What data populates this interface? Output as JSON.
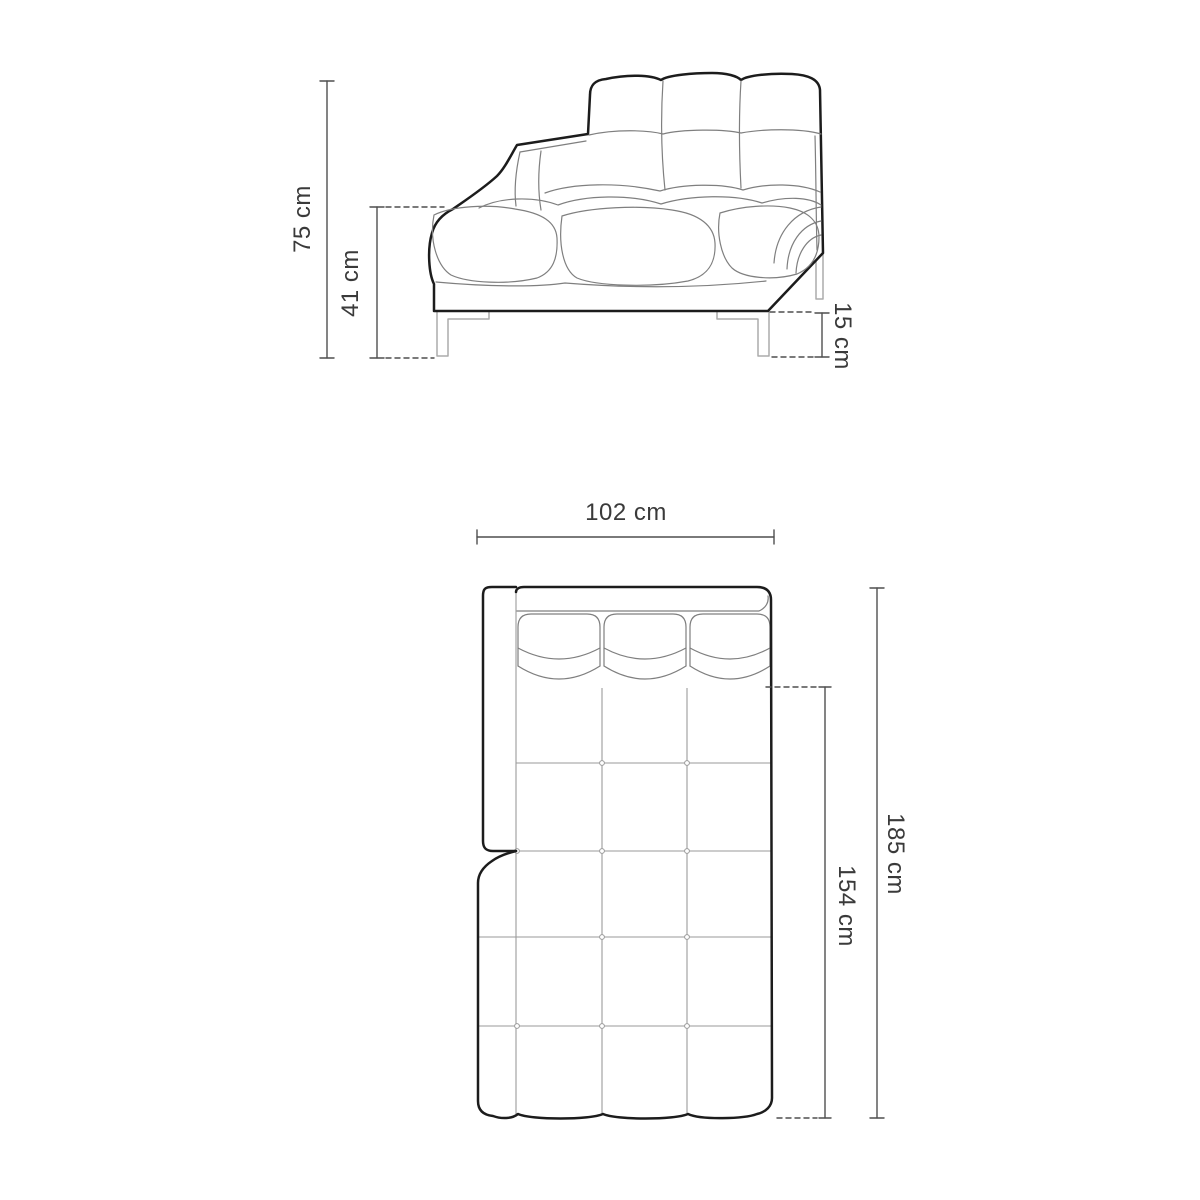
{
  "side_view": {
    "overall_height": "75 cm",
    "seat_height": "41 cm",
    "leg_height": "15 cm"
  },
  "top_view": {
    "width": "102 cm",
    "overall_length": "185 cm",
    "seat_length": "154 cm"
  },
  "colors": {
    "background": "#ffffff",
    "outline": "#1c1c1c",
    "detail": "#7f7f7f",
    "grid": "#9a9a9a",
    "leg": "#ababab",
    "dimension": "#4f4f4f",
    "text": "#3a3a3a"
  }
}
